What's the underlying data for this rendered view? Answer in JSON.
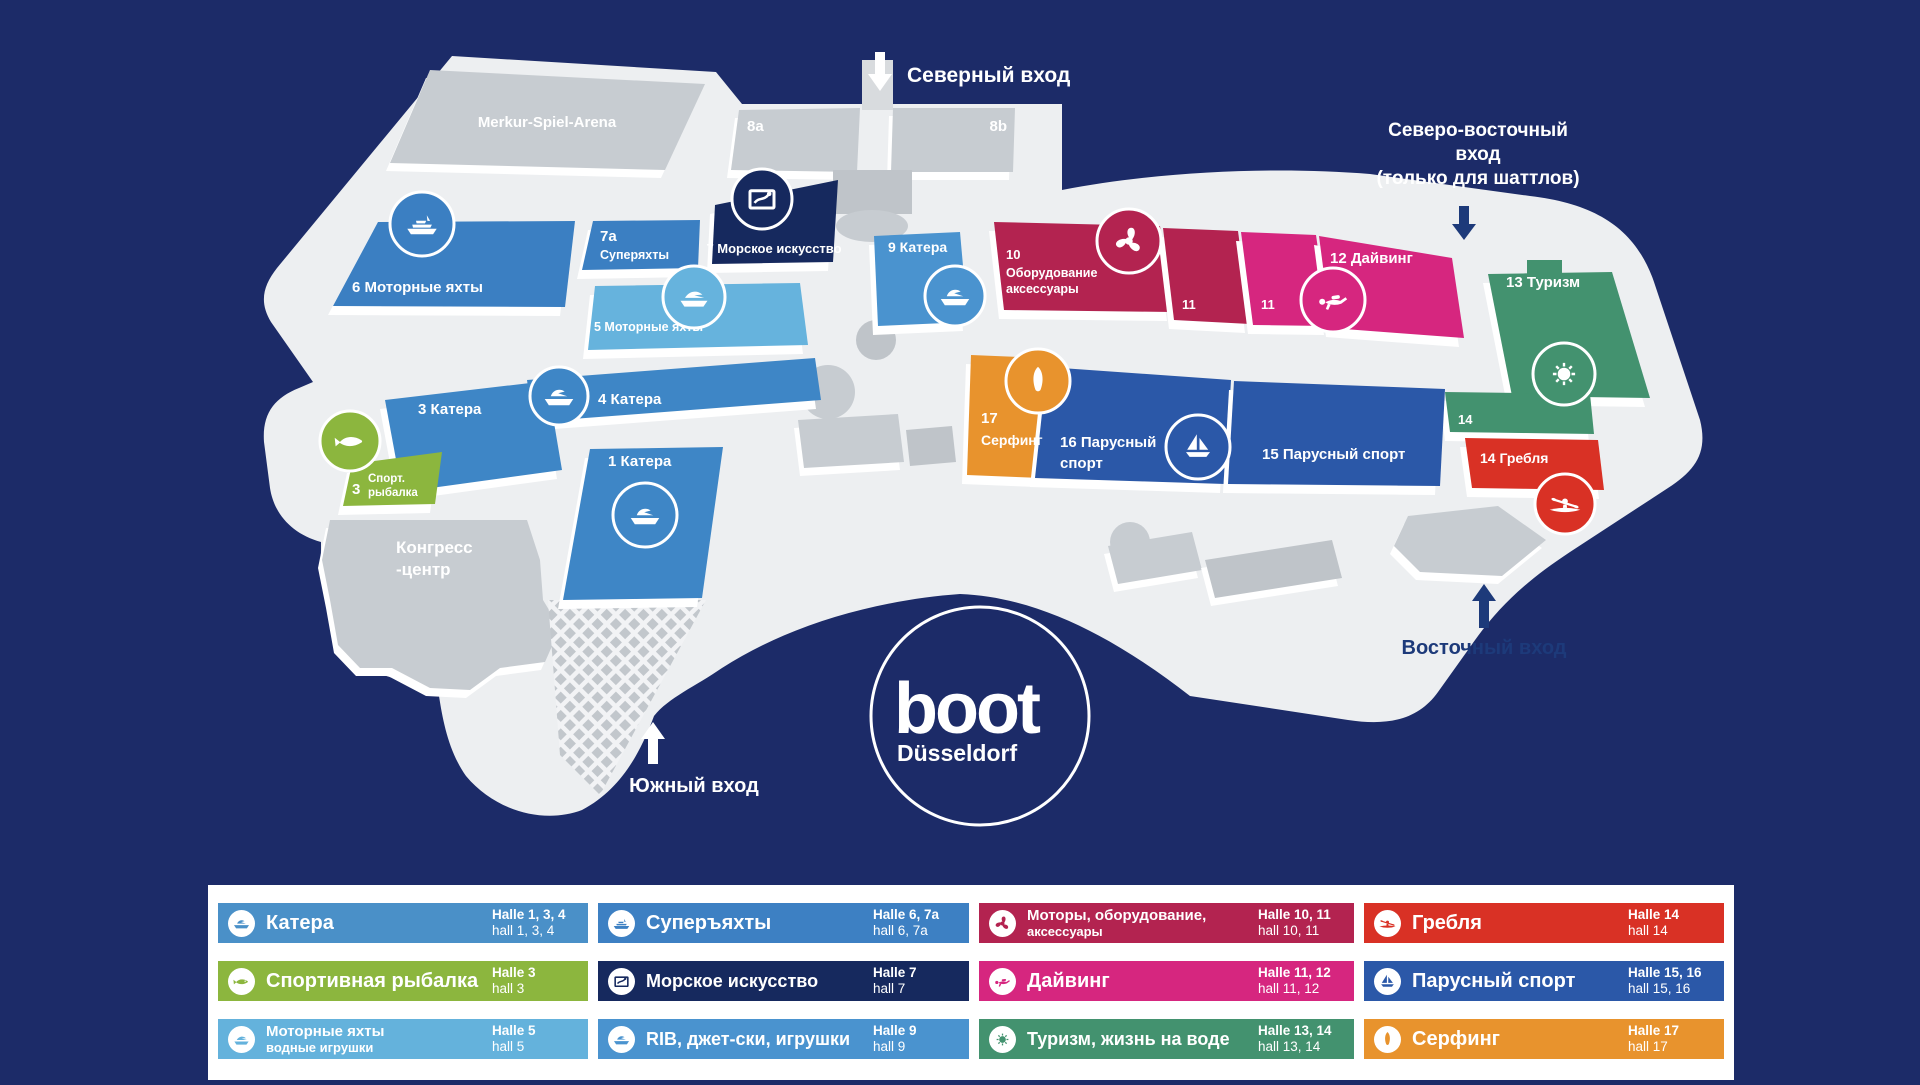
{
  "colors": {
    "background": "#1c2b68",
    "surface": "#edeff1",
    "white": "#ffffff",
    "building_gray": "#c7ccd1",
    "building_gray_dark": "#bfc4c9",
    "corridor_gray": "#d8dbde",
    "entrance_text": "#1d3a7a"
  },
  "map": {
    "entrances": {
      "north": {
        "label": "Северный вход"
      },
      "northeast": {
        "line1": "Северо-восточный",
        "line2": "вход",
        "line3": "(только для шаттлов)"
      },
      "east": {
        "label": "Восточный вход"
      },
      "south": {
        "label": "Южный вход"
      }
    },
    "landmarks": {
      "arena": {
        "label": "Merkur-Spiel-Arena"
      },
      "hall8a": {
        "label": "8a"
      },
      "hall8b": {
        "label": "8b"
      },
      "congress": {
        "line1": "Конгресс",
        "line2": "-центр"
      }
    },
    "halls": {
      "h1": {
        "label": "1 Катера",
        "color": "#3e86c6"
      },
      "h3": {
        "label": "3 Катера",
        "color": "#3e86c6"
      },
      "fishing": {
        "number": "3",
        "line1": "Спорт.",
        "line2": "рыбалка",
        "color": "#8cb63e"
      },
      "h4": {
        "label": "4 Катера",
        "color": "#3e86c6"
      },
      "h5": {
        "label": "5 Моторные яхты",
        "color": "#66b3dd"
      },
      "h6": {
        "label": "6 Моторные яхты",
        "color": "#3b7fc2"
      },
      "h7a": {
        "number": "7a",
        "label": "Суперяхты",
        "color": "#3b7fc2"
      },
      "h7": {
        "label": "7 Морское искусство",
        "color": "#16295e"
      },
      "h9": {
        "label": "9 Катера",
        "color": "#4a93cf"
      },
      "h10": {
        "number": "10",
        "line1": "Оборудование",
        "line2": "аксессуары",
        "color": "#b32350"
      },
      "h11a": {
        "label": "11",
        "color": "#b32350"
      },
      "h11b": {
        "label": "11",
        "color": "#d6267f"
      },
      "h12": {
        "label": "12 Дайвинг",
        "color": "#d6267f"
      },
      "h13": {
        "label": "13 Туризм",
        "color": "#43926f"
      },
      "h14": {
        "label": "14",
        "color": "#43926f"
      },
      "h14r": {
        "label": "14 Гребля",
        "color": "#d93125"
      },
      "h15": {
        "label": "15 Парусный спорт",
        "color": "#2b58a8"
      },
      "h16": {
        "line1": "16 Парусный",
        "line2": "спорт",
        "color": "#2b58a8"
      },
      "h17": {
        "number": "17",
        "label": "Серфинг",
        "color": "#e8932d"
      }
    }
  },
  "logo": {
    "brand": "boot",
    "city": "Düsseldorf"
  },
  "legend": {
    "items": [
      {
        "label": "Катера",
        "halle": "Halle 1, 3, 4",
        "hall": "hall 1, 3, 4",
        "color": "#4a90c8",
        "icon": "motorboat"
      },
      {
        "label": "Спортивная рыбалка",
        "halle": "Halle 3",
        "hall": "hall 3",
        "color": "#8cb63e",
        "icon": "fish"
      },
      {
        "label": "Моторные яхты",
        "label2": "водные игрушки",
        "halle": "Halle 5",
        "hall": "hall 5",
        "color": "#64b2dc",
        "icon": "motor-yacht"
      },
      {
        "label": "Суперъяхты",
        "halle": "Halle 6, 7a",
        "hall": "hall 6, 7a",
        "color": "#3d80c3",
        "icon": "superyacht"
      },
      {
        "label": "Морское искусство",
        "halle": "Halle 7",
        "hall": "hall 7",
        "color": "#16295e",
        "icon": "sea-art"
      },
      {
        "label": "RIB, джет-ски, игрушки",
        "halle": "Halle 9",
        "hall": "hall 9",
        "color": "#4a93cf",
        "icon": "rib-boat"
      },
      {
        "label": "Моторы, оборудование,",
        "label2": "аксессуары",
        "halle": "Halle 10, 11",
        "hall": "hall 10, 11",
        "color": "#b32350",
        "icon": "propeller"
      },
      {
        "label": "Дайвинг",
        "halle": "Halle 11, 12",
        "hall": "hall 11, 12",
        "color": "#d6267f",
        "icon": "diver"
      },
      {
        "label": "Туризм, жизнь на воде",
        "halle": "Halle 13, 14",
        "hall": "hall 13, 14",
        "color": "#43926f",
        "icon": "sun"
      },
      {
        "label": "Гребля",
        "halle": "Halle 14",
        "hall": "hall 14",
        "color": "#d93125",
        "icon": "kayak"
      },
      {
        "label": "Парусный спорт",
        "halle": "Halle 15, 16",
        "hall": "hall 15, 16",
        "color": "#2b58a8",
        "icon": "sailboat"
      },
      {
        "label": "Серфинг",
        "halle": "Halle 17",
        "hall": "hall 17",
        "color": "#e8932d",
        "icon": "surfboard"
      }
    ]
  }
}
